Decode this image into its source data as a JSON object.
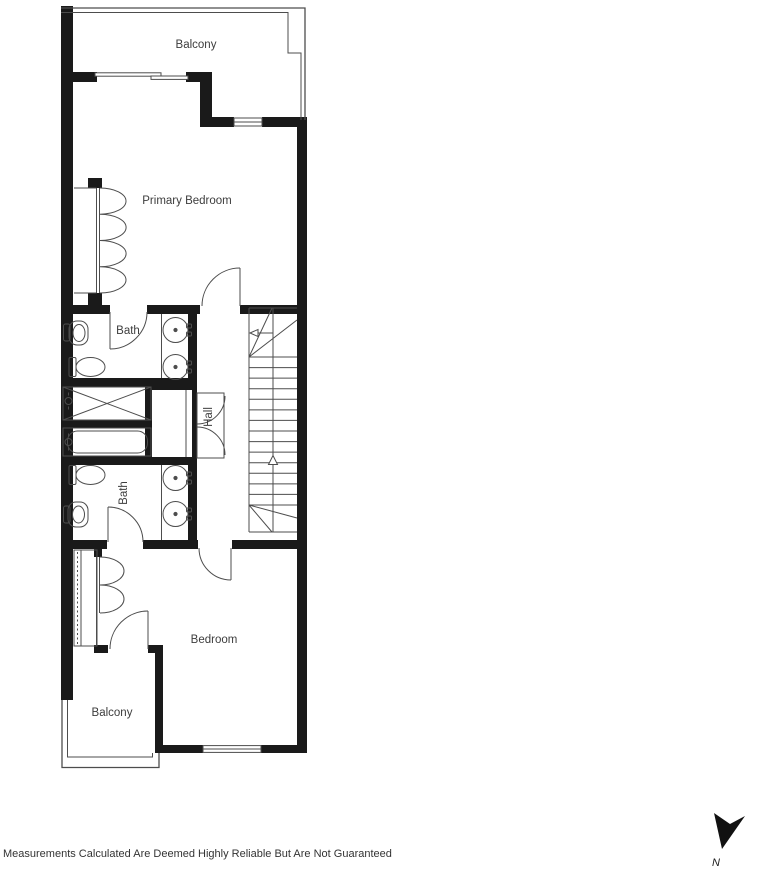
{
  "plan": {
    "rooms": {
      "balcony_top": "Balcony",
      "primary_bedroom": "Primary Bedroom",
      "bath_upper": "Bath",
      "hall": "Hall",
      "bath_lower": "Bath",
      "bedroom": "Bedroom",
      "balcony_bottom": "Balcony"
    },
    "compass": {
      "north_label": "N"
    },
    "disclaimer": "Measurements Calculated Are Deemed Highly Reliable But Are Not Guaranteed",
    "colors": {
      "wall": "#1a1a1a",
      "line": "#4d4d4d",
      "text": "#3d3d3d",
      "background": "#ffffff"
    }
  }
}
